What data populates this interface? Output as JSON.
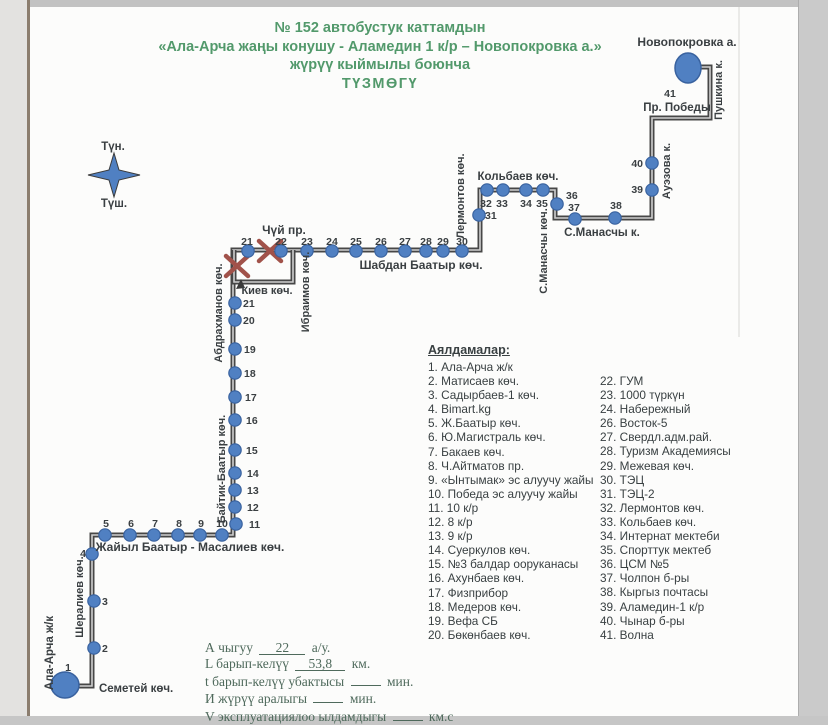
{
  "title": {
    "line1": "№ 152  автобустук каттамдын",
    "line2": "«Ала-Арча жаңы конушу  - Аламедин 1 к/р – Новопокровка а.»",
    "line3": "жүрүү кыймылы боюнча",
    "line4": "ТҮЗМӨГҮ"
  },
  "legend": {
    "heading": "Аялдамалар:",
    "col1": [
      "1. Ала-Арча ж/к",
      "2. Матисаев көч.",
      "3. Садырбаев-1 көч.",
      "4.  Bimart.kg",
      "5. Ж.Баатыр көч.",
      "6. Ю.Магистраль көч.",
      "7. Бакаев көч.",
      "8. Ч.Айтматов пр.",
      "9. «Ынтымак» эс алуучу жайы",
      "10. Победа эс алуучу жайы",
      "11. 10 к/р",
      "12. 8 к/р",
      "13. 9 к/р",
      "14. Суеркулов көч.",
      "15. №3 балдар ооруканасы",
      "16. Ахунбаев көч.",
      "17. Физприбор",
      "18. Медеров көч.",
      "19. Вефа СБ",
      "20. Бөкөнбаев көч."
    ],
    "col2": [
      "22. ГУМ",
      "23. 1000 түркүн",
      "24. Набережный",
      "26. Восток-5",
      "27. Свердл.адм.рай.",
      "28. Туризм Академиясы",
      "29. Межевая көч.",
      "30. ТЭЦ",
      "31. ТЭЦ-2",
      "32. Лермонтов көч.",
      "33. Кольбаев көч.",
      "34. Интернат мектеби",
      "35. Спорттук мектеб",
      "36. ЦСМ №5",
      "37. Чолпон б-ры",
      "38. Кыргыз почтасы",
      "39. Аламедин-1 к/р",
      "40. Чынар б-ры",
      "41. Волна"
    ]
  },
  "stats": {
    "lines": [
      {
        "pre": "А чыгуу",
        "value": "22",
        "post": "а/у.",
        "w": 46
      },
      {
        "pre": "L барып-келүү",
        "value": "53,8",
        "post": "км.",
        "w": 50
      },
      {
        "pre": "t барып-келүү убактысы",
        "value": "",
        "post": "мин.",
        "w": 30
      },
      {
        "pre": "И жүрүү аралыгы",
        "value": "",
        "post": "мин.",
        "w": 30
      },
      {
        "pre": "V эксплуатациялоо ылдамдыгы",
        "value": "",
        "post": "км.с",
        "w": 30
      }
    ]
  },
  "map": {
    "colors": {
      "route": "#474747",
      "core": "#cfcfcf",
      "stop": "#5080c2",
      "stopStroke": "#39629f",
      "xmark": "#a1524a",
      "text": "#3a3f42",
      "arrow": "#3a3a3a"
    },
    "segments": [
      "70,686 92,686 92,535 233,535 233,250 480,250 480,190 555,190 555,218 652,218 652,118 710,118 710,67 689,67",
      "234,250 234,282 293,282 293,250"
    ],
    "stops": [
      [
        248,
        251
      ],
      [
        281,
        251
      ],
      [
        307,
        251
      ],
      [
        332,
        251
      ],
      [
        356,
        251
      ],
      [
        381,
        251
      ],
      [
        405,
        251
      ],
      [
        426,
        251
      ],
      [
        443,
        251
      ],
      [
        462,
        251
      ],
      [
        235,
        303
      ],
      [
        235,
        320
      ],
      [
        235,
        349
      ],
      [
        235,
        373
      ],
      [
        235,
        397
      ],
      [
        235,
        420
      ],
      [
        235,
        450
      ],
      [
        235,
        473
      ],
      [
        235,
        490
      ],
      [
        235,
        507
      ],
      [
        236,
        524
      ],
      [
        105,
        535
      ],
      [
        130,
        535
      ],
      [
        154,
        535
      ],
      [
        178,
        535
      ],
      [
        200,
        535
      ],
      [
        222,
        535
      ],
      [
        92,
        554
      ],
      [
        94,
        601
      ],
      [
        94,
        648
      ],
      [
        479,
        215
      ],
      [
        487,
        190
      ],
      [
        503,
        190
      ],
      [
        526,
        190
      ],
      [
        543,
        190
      ],
      [
        557,
        204
      ],
      [
        575,
        219
      ],
      [
        615,
        218
      ],
      [
        652,
        190
      ],
      [
        652,
        163
      ]
    ],
    "terminals": [
      [
        688,
        68,
        13,
        15
      ],
      [
        65,
        685,
        14,
        13
      ]
    ],
    "xmarks": [
      [
        270,
        251
      ],
      [
        237,
        266
      ]
    ],
    "arrow": "236,289 241,279 245,288",
    "star": "114,153 119,170 140,175 119,180 114,197 109,180 88,175 109,170",
    "labels": [
      {
        "t": "Новопокровка а.",
        "x": 687,
        "y": 46,
        "fs": 12
      },
      {
        "t": "Пушкина к.",
        "x": 722,
        "y": 90,
        "r": 1
      },
      {
        "t": "41",
        "x": 670,
        "y": 97,
        "fs": 10.5
      },
      {
        "t": "Пр. Победы",
        "x": 677,
        "y": 111,
        "fs": 11.5
      },
      {
        "t": "Ауэзова к.",
        "x": 670,
        "y": 171,
        "r": 1
      },
      {
        "t": "40",
        "x": 643,
        "y": 167,
        "fs": 10.5,
        "a": "end"
      },
      {
        "t": "39",
        "x": 643,
        "y": 193,
        "fs": 10.5,
        "a": "end"
      },
      {
        "t": "38",
        "x": 616,
        "y": 209,
        "fs": 10.5
      },
      {
        "t": "37",
        "x": 574,
        "y": 211,
        "fs": 10.5
      },
      {
        "t": "С.Манасчы к.",
        "x": 602,
        "y": 236,
        "fs": 11.5
      },
      {
        "t": "36",
        "x": 566,
        "y": 199,
        "fs": 10.5,
        "a": "start"
      },
      {
        "t": "Кольбаев көч.",
        "x": 518,
        "y": 180,
        "fs": 11.5
      },
      {
        "t": "32",
        "x": 486,
        "y": 207,
        "fs": 10.5
      },
      {
        "t": "33",
        "x": 502,
        "y": 207,
        "fs": 10.5
      },
      {
        "t": "34",
        "x": 526,
        "y": 207,
        "fs": 10.5
      },
      {
        "t": "35",
        "x": 542,
        "y": 207,
        "fs": 10.5
      },
      {
        "t": "31",
        "x": 485,
        "y": 219,
        "fs": 10.5,
        "a": "start"
      },
      {
        "t": "Лермонтов көч.",
        "x": 464,
        "y": 196,
        "r": 1
      },
      {
        "t": "С.Манасчы көч.",
        "x": 547,
        "y": 251,
        "r": 1
      },
      {
        "t": "Чүй пр.",
        "x": 284,
        "y": 234,
        "fs": 12
      },
      {
        "t": "21",
        "x": 247,
        "y": 245,
        "fs": 10.5
      },
      {
        "t": "22",
        "x": 281,
        "y": 245,
        "fs": 10.5
      },
      {
        "t": "23",
        "x": 307,
        "y": 245,
        "fs": 10.5
      },
      {
        "t": "24",
        "x": 332,
        "y": 245,
        "fs": 10.5
      },
      {
        "t": "25",
        "x": 356,
        "y": 245,
        "fs": 10.5
      },
      {
        "t": "26",
        "x": 381,
        "y": 245,
        "fs": 10.5
      },
      {
        "t": "27",
        "x": 405,
        "y": 245,
        "fs": 10.5
      },
      {
        "t": "28",
        "x": 426,
        "y": 245,
        "fs": 10.5
      },
      {
        "t": "29",
        "x": 443,
        "y": 245,
        "fs": 10.5
      },
      {
        "t": "30",
        "x": 462,
        "y": 245,
        "fs": 10.5
      },
      {
        "t": "Шабдан Баатыр көч.",
        "x": 421,
        "y": 269,
        "fs": 12
      },
      {
        "t": "Киев көч.",
        "x": 267,
        "y": 294
      },
      {
        "t": "Ибраимов көч.",
        "x": 309,
        "y": 292,
        "r": 1
      },
      {
        "t": "Абдрахманов көч.",
        "x": 222,
        "y": 313,
        "r": 1
      },
      {
        "t": "Байтик-Баатыр көч.",
        "x": 225,
        "y": 469,
        "r": 1
      },
      {
        "t": "21",
        "x": 243,
        "y": 307,
        "fs": 10.5,
        "a": "start"
      },
      {
        "t": "20",
        "x": 243,
        "y": 324,
        "fs": 10.5,
        "a": "start"
      },
      {
        "t": "19",
        "x": 244,
        "y": 353,
        "fs": 10.5,
        "a": "start"
      },
      {
        "t": "18",
        "x": 244,
        "y": 377,
        "fs": 10.5,
        "a": "start"
      },
      {
        "t": "17",
        "x": 245,
        "y": 401,
        "fs": 10.5,
        "a": "start"
      },
      {
        "t": "16",
        "x": 246,
        "y": 424,
        "fs": 10.5,
        "a": "start"
      },
      {
        "t": "15",
        "x": 246,
        "y": 454,
        "fs": 10.5,
        "a": "start"
      },
      {
        "t": "14",
        "x": 247,
        "y": 477,
        "fs": 10.5,
        "a": "start"
      },
      {
        "t": "13",
        "x": 247,
        "y": 494,
        "fs": 10.5,
        "a": "start"
      },
      {
        "t": "12",
        "x": 247,
        "y": 511,
        "fs": 10.5,
        "a": "start"
      },
      {
        "t": "11",
        "x": 249,
        "y": 528,
        "fs": 10.5,
        "a": "start"
      },
      {
        "t": "Жайыл Баатыр -  Масалиев көч.",
        "x": 190,
        "y": 551,
        "fs": 12
      },
      {
        "t": "5",
        "x": 106,
        "y": 527,
        "fs": 10.5
      },
      {
        "t": "6",
        "x": 131,
        "y": 527,
        "fs": 10.5
      },
      {
        "t": "7",
        "x": 155,
        "y": 527,
        "fs": 10.5
      },
      {
        "t": "8",
        "x": 179,
        "y": 527,
        "fs": 10.5
      },
      {
        "t": "9",
        "x": 201,
        "y": 527,
        "fs": 10.5
      },
      {
        "t": "10",
        "x": 222,
        "y": 527,
        "fs": 10.5
      },
      {
        "t": "4",
        "x": 86,
        "y": 557,
        "fs": 10.5,
        "a": "end"
      },
      {
        "t": "3",
        "x": 102,
        "y": 605,
        "fs": 10.5,
        "a": "start"
      },
      {
        "t": "2",
        "x": 102,
        "y": 652,
        "fs": 10.5,
        "a": "start"
      },
      {
        "t": "1",
        "x": 68,
        "y": 671,
        "fs": 10.5
      },
      {
        "t": "Семетей көч.",
        "x": 99,
        "y": 692,
        "fs": 11.5,
        "a": "start"
      },
      {
        "t": "Шералиев көч.",
        "x": 83,
        "y": 597,
        "r": 1
      },
      {
        "t": "Ала-Арча ж/к",
        "x": 53,
        "y": 653,
        "r": 1,
        "fs": 11.5
      },
      {
        "t": "Түн.",
        "x": 113,
        "y": 150,
        "fs": 11.5
      },
      {
        "t": "Түш.",
        "x": 114,
        "y": 207,
        "fs": 11.5
      }
    ]
  }
}
